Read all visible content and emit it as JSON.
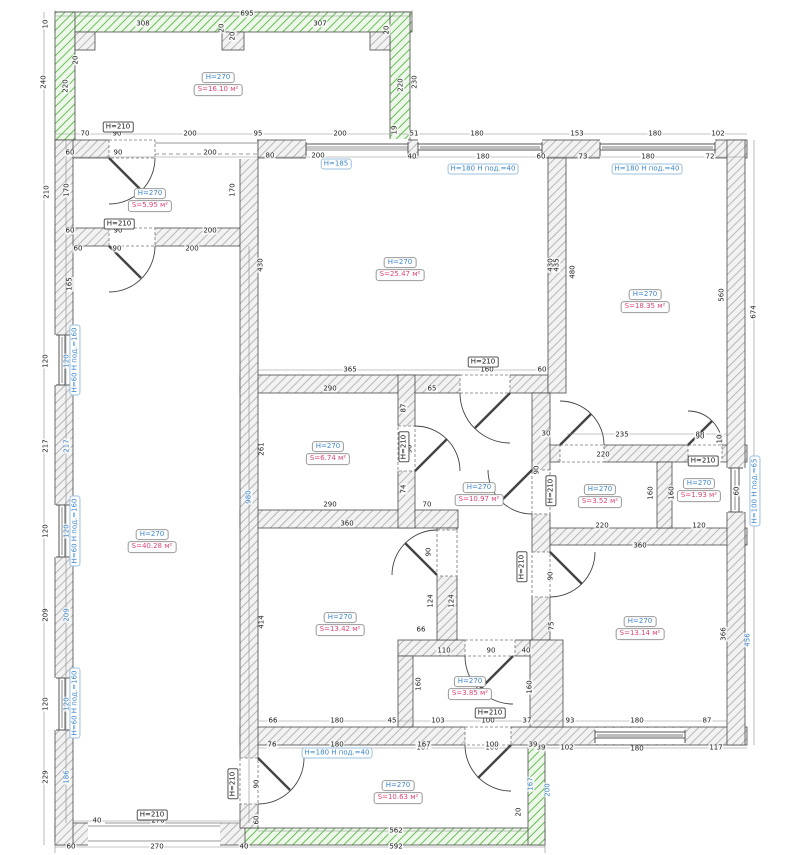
{
  "plan_title": "floor-plan-with-dimensions",
  "colors": {
    "wall_hatch": "#a9a9a9",
    "wall_fill": "#f4f4f4",
    "wall_edge": "#4a4a4a",
    "new_wall_green": "#58b847",
    "dim_text": "#222222",
    "dim_blue": "#3d85c8",
    "height_label_blue": "#3d85c8",
    "area_label_red": "#e0457b"
  },
  "rooms": [
    {
      "id": "top-room",
      "h": "H=270",
      "s": "S=16.10 м²",
      "x": 218,
      "y": 80
    },
    {
      "id": "left-small-room",
      "h": "H=270",
      "s": "S=5.95 м²",
      "x": 150,
      "y": 196
    },
    {
      "id": "central-room",
      "h": "H=270",
      "s": "S=25.47 м²",
      "x": 400,
      "y": 265
    },
    {
      "id": "right-room",
      "h": "H=270",
      "s": "S=18.35 м²",
      "x": 645,
      "y": 297
    },
    {
      "id": "left-big-room",
      "h": "H=270",
      "s": "S=40.28 м²",
      "x": 152,
      "y": 537
    },
    {
      "id": "mid-room",
      "h": "H=270",
      "s": "S=6.74 м²",
      "x": 328,
      "y": 449
    },
    {
      "id": "corridor",
      "h": "H=270",
      "s": "S=10.97 м²",
      "x": 479,
      "y": 490
    },
    {
      "id": "small-room",
      "h": "H=270",
      "s": "S=3.52 м²",
      "x": 600,
      "y": 492
    },
    {
      "id": "tiny-room",
      "h": "H=270",
      "s": "S=1.93 м²",
      "x": 699,
      "y": 486
    },
    {
      "id": "room-1342",
      "h": "H=270",
      "s": "S=13.42 м²",
      "x": 340,
      "y": 620
    },
    {
      "id": "room-1314",
      "h": "H=270",
      "s": "S=13.14 м²",
      "x": 640,
      "y": 624
    },
    {
      "id": "bathroom",
      "h": "H=270",
      "s": "S=3.85 м²",
      "x": 470,
      "y": 684
    },
    {
      "id": "bottom-room",
      "h": "H=270",
      "s": "S=10.63 м²",
      "x": 398,
      "y": 788
    }
  ],
  "door_labels": [
    {
      "text": "H=210",
      "x": 118,
      "y": 127,
      "r": 0
    },
    {
      "text": "H=210",
      "x": 119,
      "y": 224,
      "r": 0
    },
    {
      "text": "H=210",
      "x": 483,
      "y": 362,
      "r": 0
    },
    {
      "text": "H=210",
      "x": 404,
      "y": 447,
      "r": 1
    },
    {
      "text": "H=210",
      "x": 551,
      "y": 491,
      "r": 1
    },
    {
      "text": "H=210",
      "x": 522,
      "y": 567,
      "r": 1
    },
    {
      "text": "H=210",
      "x": 703,
      "y": 461,
      "r": 0
    },
    {
      "text": "H=210",
      "x": 490,
      "y": 713,
      "r": 0
    },
    {
      "text": "H=210",
      "x": 152,
      "y": 815,
      "r": 0
    },
    {
      "text": "H=210",
      "x": 233,
      "y": 784,
      "r": 1
    }
  ],
  "window_labels": [
    {
      "text": "H=185",
      "x": 336,
      "y": 164,
      "r": 0
    },
    {
      "text": "H=180  H под.=40",
      "x": 483,
      "y": 169,
      "r": 0
    },
    {
      "text": "H=180  H под.=40",
      "x": 647,
      "y": 169,
      "r": 0
    },
    {
      "text": "H=60  H под.=160",
      "x": 75,
      "y": 360,
      "r": 1
    },
    {
      "text": "H=60  H под.=160",
      "x": 75,
      "y": 531,
      "r": 1
    },
    {
      "text": "H=60  H под.=160",
      "x": 75,
      "y": 703,
      "r": 1
    },
    {
      "text": "H=100  H под.=65",
      "x": 755,
      "y": 491,
      "r": 1
    },
    {
      "text": "H=180  H под.=40",
      "x": 337,
      "y": 753,
      "r": 0
    }
  ],
  "dim_labels": [
    {
      "t": "695",
      "x": 247,
      "y": 14,
      "r": 0
    },
    {
      "t": "10",
      "x": 46,
      "y": 24,
      "r": 1
    },
    {
      "t": "240",
      "x": 44,
      "y": 82,
      "r": 1
    },
    {
      "t": "220",
      "x": 66,
      "y": 86,
      "r": 1
    },
    {
      "t": "20",
      "x": 76,
      "y": 60,
      "r": 1
    },
    {
      "t": "308",
      "x": 143,
      "y": 24,
      "r": 0
    },
    {
      "t": "20",
      "x": 222,
      "y": 28,
      "r": 1
    },
    {
      "t": "20",
      "x": 233,
      "y": 36,
      "r": 1
    },
    {
      "t": "307",
      "x": 320,
      "y": 24,
      "r": 0
    },
    {
      "t": "20",
      "x": 387,
      "y": 30,
      "r": 1
    },
    {
      "t": "220",
      "x": 401,
      "y": 85,
      "r": 1
    },
    {
      "t": "230",
      "x": 415,
      "y": 82,
      "r": 1
    },
    {
      "t": "70",
      "x": 85,
      "y": 134,
      "r": 0
    },
    {
      "t": "90",
      "x": 117,
      "y": 134,
      "r": 0
    },
    {
      "t": "200",
      "x": 190,
      "y": 134,
      "r": 0
    },
    {
      "t": "95",
      "x": 258,
      "y": 134,
      "r": 0
    },
    {
      "t": "200",
      "x": 340,
      "y": 134,
      "r": 0
    },
    {
      "t": "19",
      "x": 395,
      "y": 130,
      "r": 1
    },
    {
      "t": "51",
      "x": 414,
      "y": 134,
      "r": 0
    },
    {
      "t": "180",
      "x": 477,
      "y": 134,
      "r": 0
    },
    {
      "t": "153",
      "x": 577,
      "y": 134,
      "r": 0
    },
    {
      "t": "180",
      "x": 655,
      "y": 134,
      "r": 0
    },
    {
      "t": "102",
      "x": 718,
      "y": 134,
      "r": 0
    },
    {
      "t": "60",
      "x": 70,
      "y": 153,
      "r": 0
    },
    {
      "t": "90",
      "x": 118,
      "y": 153,
      "r": 0
    },
    {
      "t": "200",
      "x": 210,
      "y": 153,
      "r": 0
    },
    {
      "t": "80",
      "x": 270,
      "y": 156,
      "r": 0
    },
    {
      "t": "200",
      "x": 318,
      "y": 156,
      "r": 0
    },
    {
      "t": "40",
      "x": 412,
      "y": 157,
      "r": 0
    },
    {
      "t": "180",
      "x": 483,
      "y": 157,
      "r": 0
    },
    {
      "t": "60",
      "x": 541,
      "y": 157,
      "r": 0
    },
    {
      "t": "73",
      "x": 583,
      "y": 157,
      "r": 0
    },
    {
      "t": "180",
      "x": 648,
      "y": 157,
      "r": 0
    },
    {
      "t": "72",
      "x": 710,
      "y": 157,
      "r": 0
    },
    {
      "t": "430",
      "x": 261,
      "y": 265,
      "r": 1
    },
    {
      "t": "430",
      "x": 551,
      "y": 265,
      "r": 1
    },
    {
      "t": "365",
      "x": 350,
      "y": 370,
      "r": 0
    },
    {
      "t": "160",
      "x": 487,
      "y": 370,
      "r": 0
    },
    {
      "t": "60",
      "x": 542,
      "y": 370,
      "r": 0
    },
    {
      "t": "435",
      "x": 557,
      "y": 265,
      "r": 1
    },
    {
      "t": "480",
      "x": 573,
      "y": 272,
      "r": 1
    },
    {
      "t": "560",
      "x": 722,
      "y": 295,
      "r": 1
    },
    {
      "t": "674",
      "x": 754,
      "y": 312,
      "r": 1
    },
    {
      "t": "235",
      "x": 622,
      "y": 435,
      "r": 0
    },
    {
      "t": "80",
      "x": 700,
      "y": 435,
      "r": 0
    },
    {
      "t": "10",
      "x": 721,
      "y": 438,
      "r": 1
    },
    {
      "t": "210",
      "x": 47,
      "y": 192,
      "r": 1
    },
    {
      "t": "170",
      "x": 67,
      "y": 190,
      "r": 1
    },
    {
      "t": "170",
      "x": 233,
      "y": 190,
      "r": 1
    },
    {
      "t": "60",
      "x": 70,
      "y": 231,
      "r": 0
    },
    {
      "t": "90",
      "x": 118,
      "y": 231,
      "r": 0
    },
    {
      "t": "200",
      "x": 210,
      "y": 231,
      "r": 0
    },
    {
      "t": "60",
      "x": 78,
      "y": 249,
      "r": 0
    },
    {
      "t": "90",
      "x": 117,
      "y": 249,
      "r": 0
    },
    {
      "t": "200",
      "x": 192,
      "y": 249,
      "r": 0
    },
    {
      "t": "165",
      "x": 70,
      "y": 284,
      "r": 1
    },
    {
      "t": "980",
      "x": 249,
      "y": 497,
      "r": 1,
      "b": 1
    },
    {
      "t": "120",
      "x": 46,
      "y": 361,
      "r": 1
    },
    {
      "t": "120",
      "x": 67,
      "y": 361,
      "r": 1,
      "b": 1
    },
    {
      "t": "217",
      "x": 46,
      "y": 446,
      "r": 1
    },
    {
      "t": "217",
      "x": 67,
      "y": 446,
      "r": 1,
      "b": 1
    },
    {
      "t": "120",
      "x": 46,
      "y": 531,
      "r": 1
    },
    {
      "t": "120",
      "x": 67,
      "y": 531,
      "r": 1,
      "b": 1
    },
    {
      "t": "209",
      "x": 46,
      "y": 615,
      "r": 1
    },
    {
      "t": "209",
      "x": 67,
      "y": 615,
      "r": 1,
      "b": 1
    },
    {
      "t": "120",
      "x": 46,
      "y": 704,
      "r": 1
    },
    {
      "t": "120",
      "x": 67,
      "y": 704,
      "r": 1,
      "b": 1
    },
    {
      "t": "186",
      "x": 67,
      "y": 777,
      "r": 1,
      "b": 1
    },
    {
      "t": "229",
      "x": 46,
      "y": 777,
      "r": 1
    },
    {
      "t": "40",
      "x": 97,
      "y": 821,
      "r": 0
    },
    {
      "t": "270",
      "x": 158,
      "y": 821,
      "r": 0
    },
    {
      "t": "60",
      "x": 71,
      "y": 847,
      "r": 0
    },
    {
      "t": "270",
      "x": 157,
      "y": 847,
      "r": 0
    },
    {
      "t": "40",
      "x": 244,
      "y": 847,
      "r": 0
    },
    {
      "t": "290",
      "x": 330,
      "y": 389,
      "r": 0
    },
    {
      "t": "261",
      "x": 262,
      "y": 449,
      "r": 1
    },
    {
      "t": "87",
      "x": 404,
      "y": 408,
      "r": 1
    },
    {
      "t": "90",
      "x": 410,
      "y": 449,
      "r": 1
    },
    {
      "t": "74",
      "x": 404,
      "y": 489,
      "r": 1
    },
    {
      "t": "290",
      "x": 330,
      "y": 505,
      "r": 0
    },
    {
      "t": "70",
      "x": 427,
      "y": 505,
      "r": 0
    },
    {
      "t": "65",
      "x": 432,
      "y": 389,
      "r": 0
    },
    {
      "t": "30",
      "x": 546,
      "y": 434,
      "r": 0
    },
    {
      "t": "90",
      "x": 537,
      "y": 470,
      "r": 1
    },
    {
      "t": "220",
      "x": 603,
      "y": 455,
      "r": 0
    },
    {
      "t": "220",
      "x": 602,
      "y": 526,
      "r": 0
    },
    {
      "t": "90",
      "x": 700,
      "y": 437,
      "r": 0
    },
    {
      "t": "10",
      "x": 720,
      "y": 439,
      "r": 1
    },
    {
      "t": "160",
      "x": 651,
      "y": 493,
      "r": 1
    },
    {
      "t": "160",
      "x": 672,
      "y": 493,
      "r": 1
    },
    {
      "t": "120",
      "x": 699,
      "y": 526,
      "r": 0
    },
    {
      "t": "60",
      "x": 737,
      "y": 491,
      "r": 1
    },
    {
      "t": "360",
      "x": 347,
      "y": 524,
      "r": 0
    },
    {
      "t": "414",
      "x": 262,
      "y": 622,
      "r": 1
    },
    {
      "t": "90",
      "x": 429,
      "y": 552,
      "r": 1
    },
    {
      "t": "124",
      "x": 431,
      "y": 601,
      "r": 1
    },
    {
      "t": "124",
      "x": 452,
      "y": 601,
      "r": 1
    },
    {
      "t": "66",
      "x": 421,
      "y": 630,
      "r": 0
    },
    {
      "t": "110",
      "x": 444,
      "y": 651,
      "r": 0
    },
    {
      "t": "160",
      "x": 419,
      "y": 684,
      "r": 1
    },
    {
      "t": "66",
      "x": 273,
      "y": 721,
      "r": 0
    },
    {
      "t": "180",
      "x": 337,
      "y": 721,
      "r": 0
    },
    {
      "t": "45",
      "x": 392,
      "y": 721,
      "r": 0
    },
    {
      "t": "103",
      "x": 438,
      "y": 721,
      "r": 0
    },
    {
      "t": "90",
      "x": 491,
      "y": 651,
      "r": 0
    },
    {
      "t": "40",
      "x": 526,
      "y": 651,
      "r": 0
    },
    {
      "t": "160",
      "x": 530,
      "y": 687,
      "r": 1
    },
    {
      "t": "100",
      "x": 488,
      "y": 721,
      "r": 0
    },
    {
      "t": "37",
      "x": 527,
      "y": 721,
      "r": 0
    },
    {
      "t": "167",
      "x": 423,
      "y": 748,
      "r": 0
    },
    {
      "t": "100",
      "x": 492,
      "y": 748,
      "r": 0
    },
    {
      "t": "39",
      "x": 541,
      "y": 748,
      "r": 0
    },
    {
      "t": "360",
      "x": 640,
      "y": 546,
      "r": 0
    },
    {
      "t": "90",
      "x": 551,
      "y": 576,
      "r": 1
    },
    {
      "t": "75",
      "x": 552,
      "y": 626,
      "r": 1
    },
    {
      "t": "366",
      "x": 724,
      "y": 634,
      "r": 1
    },
    {
      "t": "456",
      "x": 748,
      "y": 640,
      "r": 1,
      "b": 1
    },
    {
      "t": "93",
      "x": 570,
      "y": 721,
      "r": 0
    },
    {
      "t": "180",
      "x": 637,
      "y": 721,
      "r": 0
    },
    {
      "t": "87",
      "x": 707,
      "y": 721,
      "r": 0
    },
    {
      "t": "102",
      "x": 567,
      "y": 748,
      "r": 0
    },
    {
      "t": "180",
      "x": 637,
      "y": 749,
      "r": 0
    },
    {
      "t": "117",
      "x": 716,
      "y": 748,
      "r": 0
    },
    {
      "t": "76",
      "x": 272,
      "y": 745,
      "r": 0
    },
    {
      "t": "180",
      "x": 337,
      "y": 745,
      "r": 0
    },
    {
      "t": "167",
      "x": 424,
      "y": 745,
      "r": 0
    },
    {
      "t": "100",
      "x": 492,
      "y": 745,
      "r": 0
    },
    {
      "t": "39",
      "x": 533,
      "y": 745,
      "r": 0
    },
    {
      "t": "90",
      "x": 257,
      "y": 784,
      "r": 1
    },
    {
      "t": "60",
      "x": 257,
      "y": 820,
      "r": 1
    },
    {
      "t": "167",
      "x": 531,
      "y": 784,
      "r": 1,
      "b": 1
    },
    {
      "t": "200",
      "x": 548,
      "y": 790,
      "r": 1,
      "b": 1
    },
    {
      "t": "20",
      "x": 519,
      "y": 812,
      "r": 1
    },
    {
      "t": "562",
      "x": 396,
      "y": 831,
      "r": 0
    },
    {
      "t": "592",
      "x": 396,
      "y": 847,
      "r": 0
    }
  ]
}
